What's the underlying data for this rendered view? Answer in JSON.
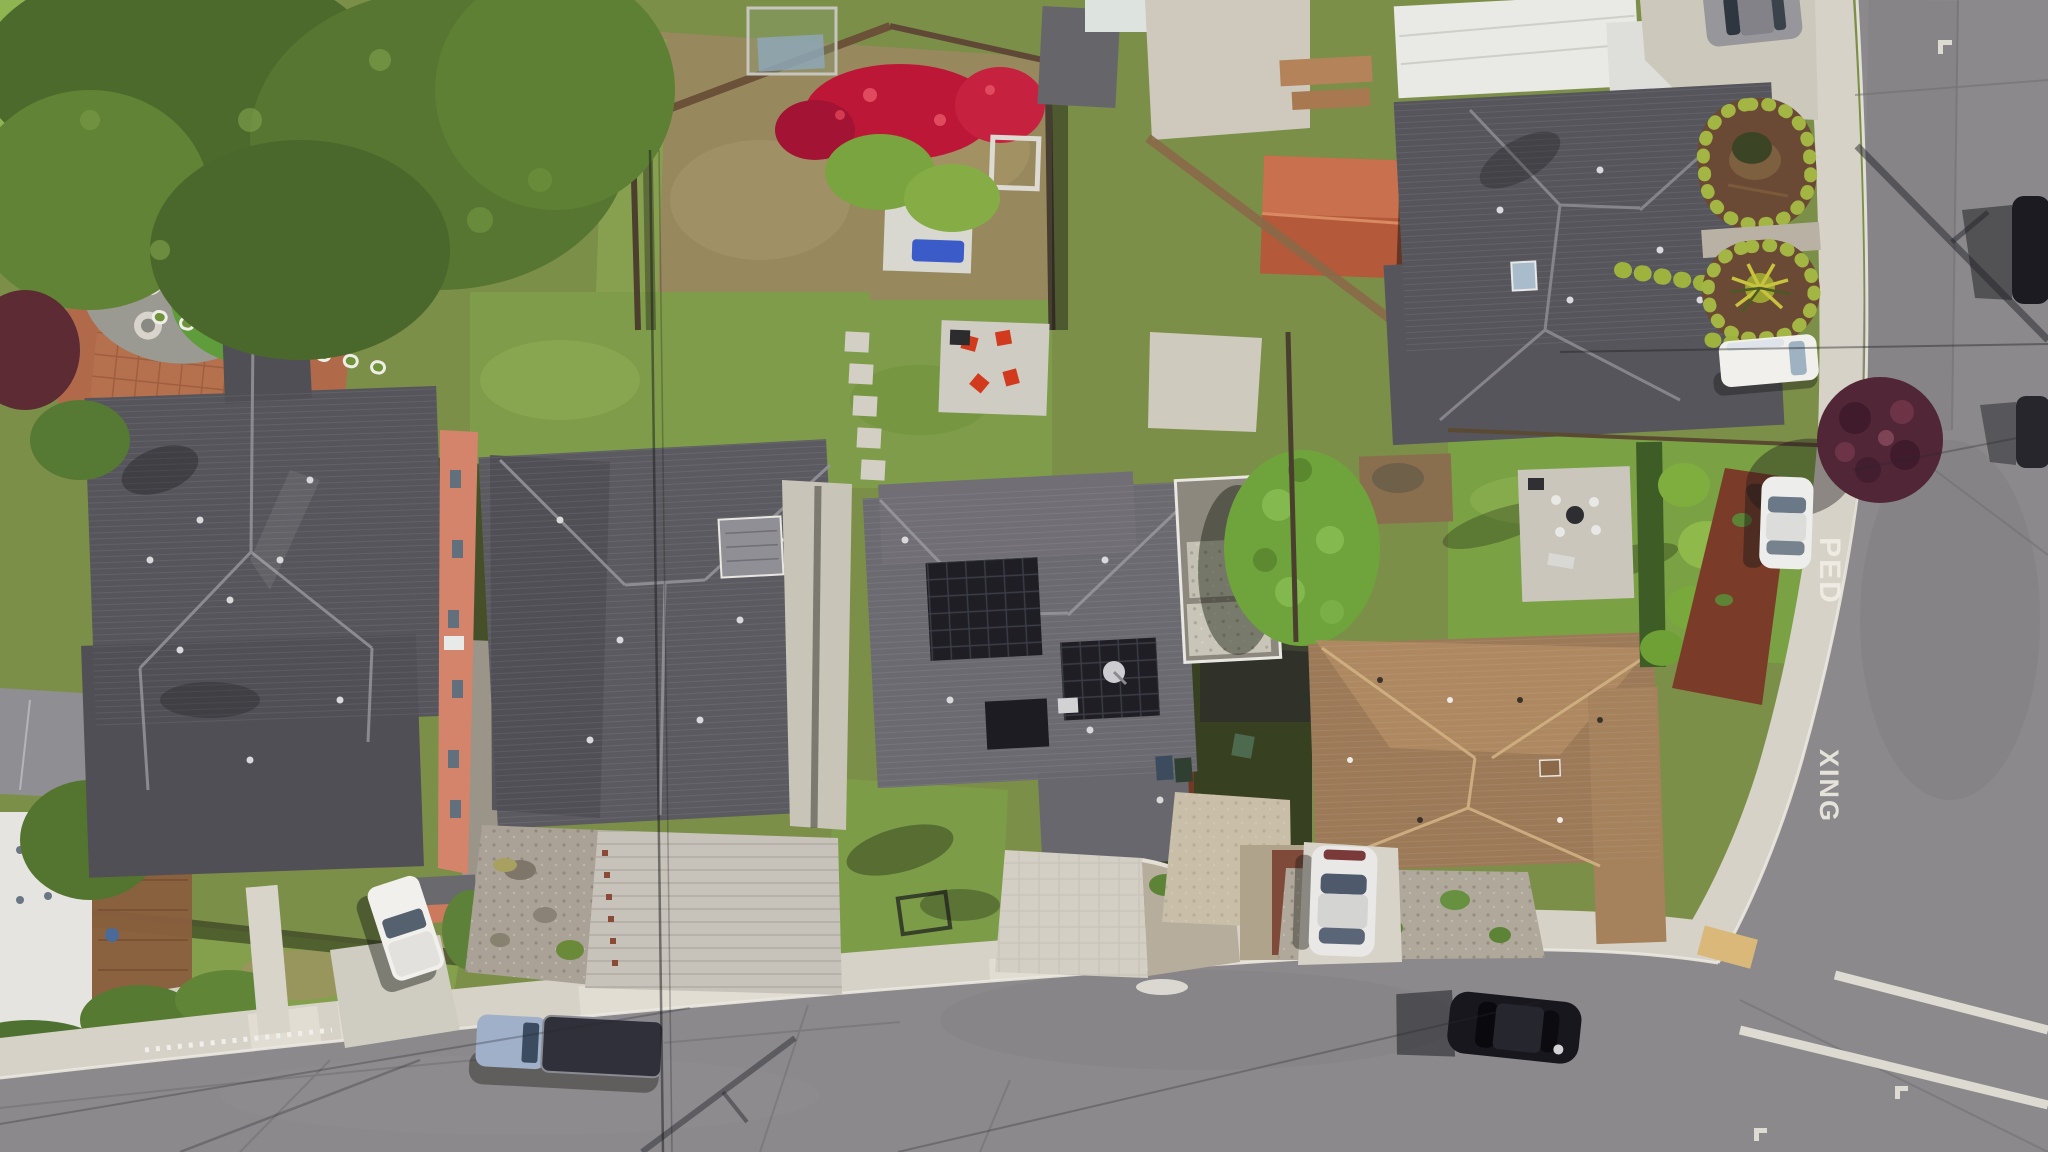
{
  "scene": {
    "kind": "aerial-drone-photo",
    "description": "Top-down aerial view of a suburban residential block: five houses with gray and brown shingle roofs, landscaped yards and backyards, a curved street along the bottom meeting a vertical side street on the right marked PED XING, parked vehicles and long utility-pole shadows.",
    "width_px": 2048,
    "height_px": 1152
  },
  "road_markings": {
    "ped_label": "PED",
    "xing_label": "XING",
    "crosswalk_line_count": 2,
    "parking_l_marks": 3
  },
  "palette": {
    "asphalt": "#8b898b",
    "asphaltDark": "#7c7a7c",
    "concrete": "#d6d2c8",
    "concreteBright": "#e3dfd5",
    "paver": "#c7c3bb",
    "gravel": "#b0a89a",
    "grassBase": "#7c8f48",
    "lawn": "#84a24c",
    "lawnBright": "#8fb553",
    "turf": "#5f9c3b",
    "treeDark": "#4b6a2b",
    "treeGreen": "#6fa43c",
    "hedge": "#a3b542",
    "roofDark": "#55555b",
    "roofMid": "#6b6a70",
    "roofBrown": "#9c7a58",
    "roofBrownL": "#b08a62",
    "solar": "#1e1e24",
    "salmon": "#d4846a",
    "terracotta": "#b06a4a",
    "mulchRed": "#7a3c28",
    "mulchBrown": "#6a4a34",
    "flowerRed": "#bd1737",
    "purpleTree": "#512637",
    "spaBlue": "#3b5bc8",
    "chairRed": "#d23a1e",
    "vWhite": "#f1f0ec",
    "vBlack": "#17171d",
    "vSilver": "#e9e8e6",
    "vBlueGray": "#9fb0c8",
    "shedRed": "#b4593a",
    "roadPaint": "#f2efe6"
  },
  "objects": {
    "houses": [
      {
        "name": "house-left-large-gray",
        "roof": "dark gray shingle hip roof",
        "detail": "salmon two-story east wall with windows"
      },
      {
        "name": "house-second-gray",
        "roof": "dark gray hip roof",
        "detail": "gravel front yard and paver driveway"
      },
      {
        "name": "house-center-solar",
        "roof": "gray hip roof with black solar panels",
        "detail": "satellite dish, front lawn"
      },
      {
        "name": "house-brown-roof",
        "roof": "tan-brown shingle hip roof",
        "detail": "gravel front yard, silver car in driveway"
      },
      {
        "name": "house-top-right-gray",
        "roof": "dark gray hip roof",
        "detail": "oval hedge-lined mulch beds with yucca"
      }
    ],
    "vehicles": [
      {
        "name": "white-pickup-driveway"
      },
      {
        "name": "blue-gray-pickup-street"
      },
      {
        "name": "black-sedan-street"
      },
      {
        "name": "silver-car-driveway"
      },
      {
        "name": "white-van-curb"
      },
      {
        "name": "white-sedan-curb"
      },
      {
        "name": "gray-car-top-edge"
      },
      {
        "name": "dark-car-right-edge-upper"
      },
      {
        "name": "dark-car-right-edge-lower"
      }
    ],
    "yard_features": [
      {
        "name": "garden-terrace-raised-beds",
        "bed_count": 9
      },
      {
        "name": "round-artificial-lawn"
      },
      {
        "name": "bougainvillea-red-flowers"
      },
      {
        "name": "spa-with-blue-water"
      },
      {
        "name": "patio-red-chairs",
        "chair_count": 4
      },
      {
        "name": "stepping-stone-path"
      },
      {
        "name": "red-roof-shed"
      },
      {
        "name": "pebble-roof-carport"
      },
      {
        "name": "large-green-tree"
      },
      {
        "name": "purple-leaf-tree"
      }
    ],
    "street_features": [
      {
        "name": "horizontal-street-bottom"
      },
      {
        "name": "vertical-street-right"
      },
      {
        "name": "corner-curb-ramp-tactile-pad"
      },
      {
        "name": "crosswalk-lines"
      },
      {
        "name": "sidewalk"
      },
      {
        "name": "white-picket-fence"
      },
      {
        "name": "utility-pole-shadows"
      },
      {
        "name": "overhead-wires"
      }
    ]
  }
}
